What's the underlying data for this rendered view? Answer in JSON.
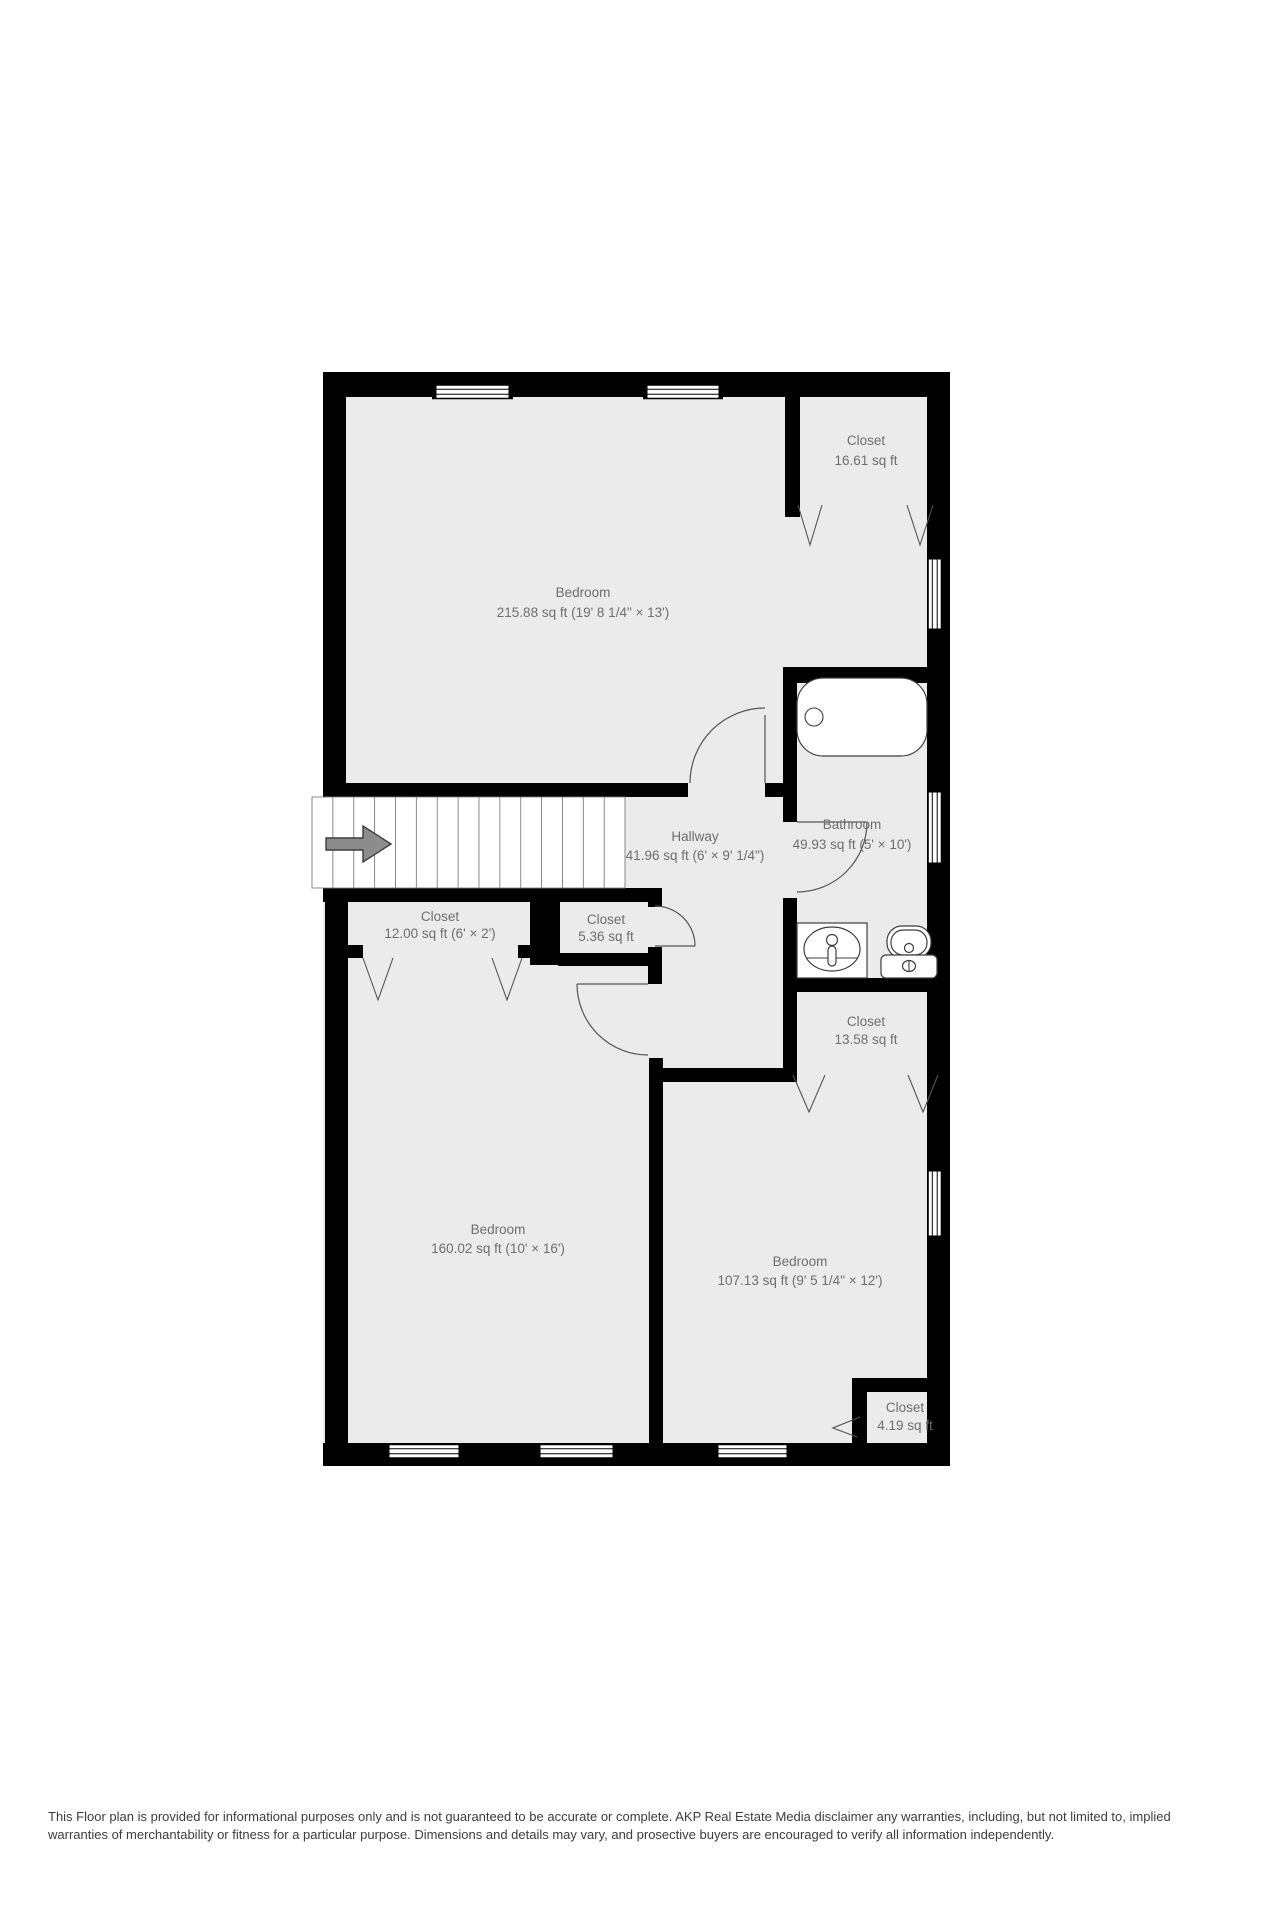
{
  "plan": {
    "wall_color": "#000000",
    "floor_color": "#ebebeb",
    "label_color": "#6e6e6e",
    "rooms": [
      {
        "id": "bedroom-top",
        "name": "Bedroom",
        "dims": "215.88 sq ft (19' 8 1/4\" × 13')"
      },
      {
        "id": "closet-top",
        "name": "Closet",
        "dims": "16.61 sq ft"
      },
      {
        "id": "bathroom",
        "name": "Bathroom",
        "dims": "49.93 sq ft (5' × 10')"
      },
      {
        "id": "hallway",
        "name": "Hallway",
        "dims": "41.96 sq ft (6' × 9' 1/4\")"
      },
      {
        "id": "closet-hall",
        "name": "Closet",
        "dims": "12.00 sq ft (6' × 2')"
      },
      {
        "id": "closet-small",
        "name": "Closet",
        "dims": "5.36 sq ft"
      },
      {
        "id": "closet-mid",
        "name": "Closet",
        "dims": "13.58 sq ft"
      },
      {
        "id": "bedroom-left",
        "name": "Bedroom",
        "dims": "160.02 sq ft (10' × 16')"
      },
      {
        "id": "bedroom-right",
        "name": "Bedroom",
        "dims": "107.13 sq ft (9' 5 1/4\" × 12')"
      },
      {
        "id": "closet-tiny",
        "name": "Closet",
        "dims": "4.19 sq ft"
      }
    ]
  },
  "disclaimer": {
    "line1": "This Floor plan is provided for informational purposes only and is not guaranteed to be accurate or complete. AKP Real Estate Media disclaimer any warranties, including, but not limited to, implied",
    "line2": "warranties of merchantability or fitness for a particular purpose. Dimensions and details may vary, and prosective buyers are encouraged to verify all information independently."
  }
}
